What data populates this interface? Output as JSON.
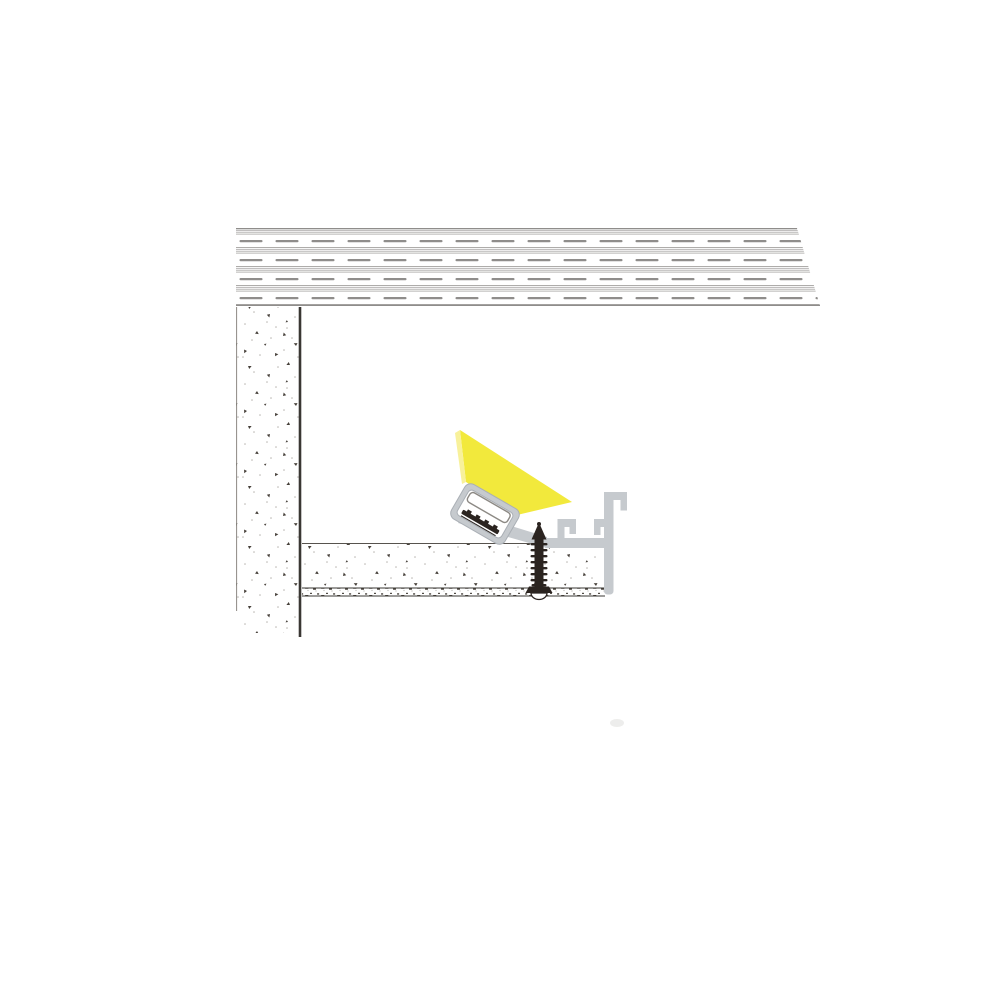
{
  "illustration": {
    "name": "led-profile-drywall-cross-section",
    "alt": "Cross-section installation diagram: plaster-in aluminum LED profile mounted at a drywall ceiling edge, tilted LED channel with diffuser emitting a yellow light beam, fastened with a screw",
    "parts": {
      "ceiling_slab": "ceiling-slab",
      "wall": "masonry-wall",
      "drywall_board": "drywall-board",
      "plaster_layer": "plaster-skim-layer",
      "aluminum_profile": "aluminum-trim-profile",
      "led_channel": "led-channel",
      "diffuser": "diffuser-lens",
      "led_strip": "led-strip",
      "light_beam": "light-beam",
      "screw": "mounting-screw"
    },
    "colors": {
      "beam_yellow": "#F2E93C",
      "beam_yellow_light": "#F8F19B",
      "aluminum_gray": "#C6CACE",
      "aluminum_edge": "#AAAFB5",
      "hatch_line": "#A5A3A1",
      "hatch_dash": "#8F8D8B",
      "speckle_dark": "#453F39",
      "speckle_light": "#B8B5B1",
      "outline_dark": "#3A3733",
      "outline_mid": "#57534E",
      "outline_light": "#8C8984",
      "screw_dark": "#2B2420",
      "cavity_white": "#FFFFFF",
      "smudge_gray": "#E6E6E4"
    }
  }
}
